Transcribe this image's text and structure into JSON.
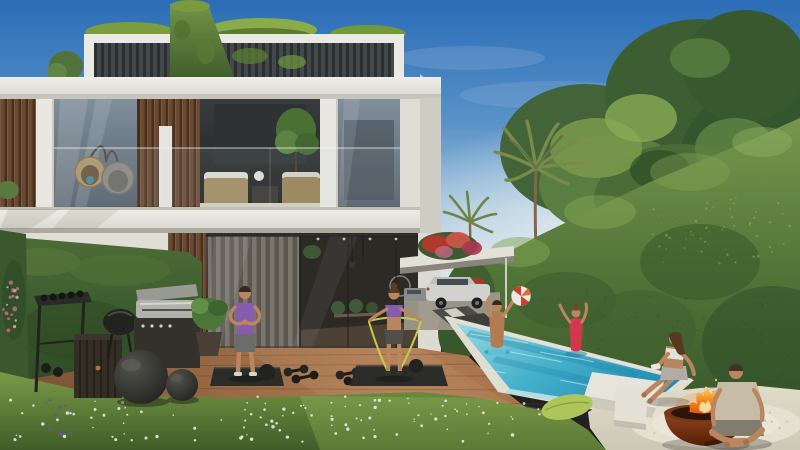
{
  "scene": {
    "type": "photorealistic 3D architectural rendering (no text in image)",
    "setting": "backyard of a modern two-storey white villa with rooftop pergola, outdoor gym deck, long swimming pool, tall clipped hedge and fire-pit lounge",
    "time_of_day": "sunny daytime, clear blue sky",
    "people_count": 6
  },
  "objects": [
    {
      "name": "villa",
      "desc": "modern white two-storey house with glass walls, wood-slat cladding, rooftop pergola with planting and a tall green living-wall fin"
    },
    {
      "name": "rooftop-pergola",
      "desc": "white frame with dark louvres and greenery on top"
    },
    {
      "name": "green-wall-fin",
      "desc": "vertical garden panel rising above the roof"
    },
    {
      "name": "upper-terrace",
      "desc": "glass balustrade terrace with two hanging egg chairs and wicker sofas with white cushions"
    },
    {
      "name": "ground-floor-glass",
      "desc": "full-height glazing with grey curtains and dark interior with dining furniture"
    },
    {
      "name": "exercising-man",
      "desc": "man in purple tank top and grey shorts standing on a black mat"
    },
    {
      "name": "exercising-woman",
      "desc": "woman in purple sports bra using a yellow resistance band on a black mat"
    },
    {
      "name": "dumbbells",
      "desc": "two pairs of black dumbbells lying on the wooden deck"
    },
    {
      "name": "outdoor-gym",
      "desc": "dumbbell rack, slatted cabinet, kettle grill, stainless gas barbecue, two large dark exercise balls, potted plant"
    },
    {
      "name": "pool",
      "desc": "long turquoise pool with white coping running diagonally along the hedge"
    },
    {
      "name": "swimmer-man",
      "desc": "man in light-blue trunks playing with a beach ball"
    },
    {
      "name": "swimmer-woman",
      "desc": "woman in a red swimsuit in the pool"
    },
    {
      "name": "beach-ball",
      "desc": "white and red beach ball in the air"
    },
    {
      "name": "hedge-wall",
      "desc": "tall dense clipped hedge on the right, taller toward the camera"
    },
    {
      "name": "carport",
      "desc": "white pergola carport with a silver SUV, a red car and a grey car, bougainvillea above"
    },
    {
      "name": "sun-loungers",
      "desc": "dark grey loungers with a white towel near the pool head"
    },
    {
      "name": "palm-trees",
      "desc": "palms and large sunlit trees behind the hedge with glimpses of a neighbouring white building"
    },
    {
      "name": "patio",
      "desc": "cream stone lounge area with a white pebble circle"
    },
    {
      "name": "fire-bowl",
      "desc": "rust-coloured steel fire bowl with burning flames"
    },
    {
      "name": "seated-woman",
      "desc": "woman in white top sitting on the pool ledge near the fire"
    },
    {
      "name": "seated-man",
      "desc": "man in beige t-shirt sitting cross-legged on the patio"
    },
    {
      "name": "pillows",
      "desc": "lime-green cushion on the grass and black-and-white patterned cushion on the patio"
    },
    {
      "name": "foreground-grass",
      "desc": "low meadow strip with many small white daisies and a few purple and pink flowers"
    },
    {
      "name": "wood-deck",
      "desc": "warm brown plank deck used as the outdoor gym floor"
    }
  ],
  "colors": {
    "sky_top": "#2c70bd",
    "sky_horizon": "#e4eef4",
    "villa_white": "#f2f0ea",
    "villa_shadow": "#d7d4ca",
    "wood_slat": "#6e4b35",
    "glass_top": "#8494a2",
    "glass_bottom": "#57616b",
    "interior_dark": "#2e2b26",
    "curtain_grey": "#7e7a71",
    "hedge_light": "#7a9c50",
    "hedge_dark": "#35522a",
    "tree_dark": "#3f6134",
    "tree_light": "#7fa04f",
    "palm_green": "#7d8f4e",
    "grass_light": "#7da049",
    "grass_dark": "#42602a",
    "deck_wood": "#a9744a",
    "deck_dark": "#7c4e2e",
    "pool_light": "#9fe2ec",
    "pool_deep": "#2391ba",
    "coping": "#e9e6d9",
    "patio_stone": "#e9e3d2",
    "pebble_light": "#efe9d9",
    "fire_orange": "#ff8c1a",
    "fire_yellow": "#ffe27a",
    "bowl_rust": "#8a4520",
    "skin": "#c08b62",
    "purple": "#8a5fb5",
    "red_swimsuit": "#d93a4e",
    "blue_trunks": "#6ccfe4",
    "band": "#cdd34f",
    "pillow_green": "#b5cc5e",
    "car_white": "#d9dad6",
    "car_red": "#a83b30",
    "mat": "#2c2c29",
    "equipment": "#26261f"
  }
}
